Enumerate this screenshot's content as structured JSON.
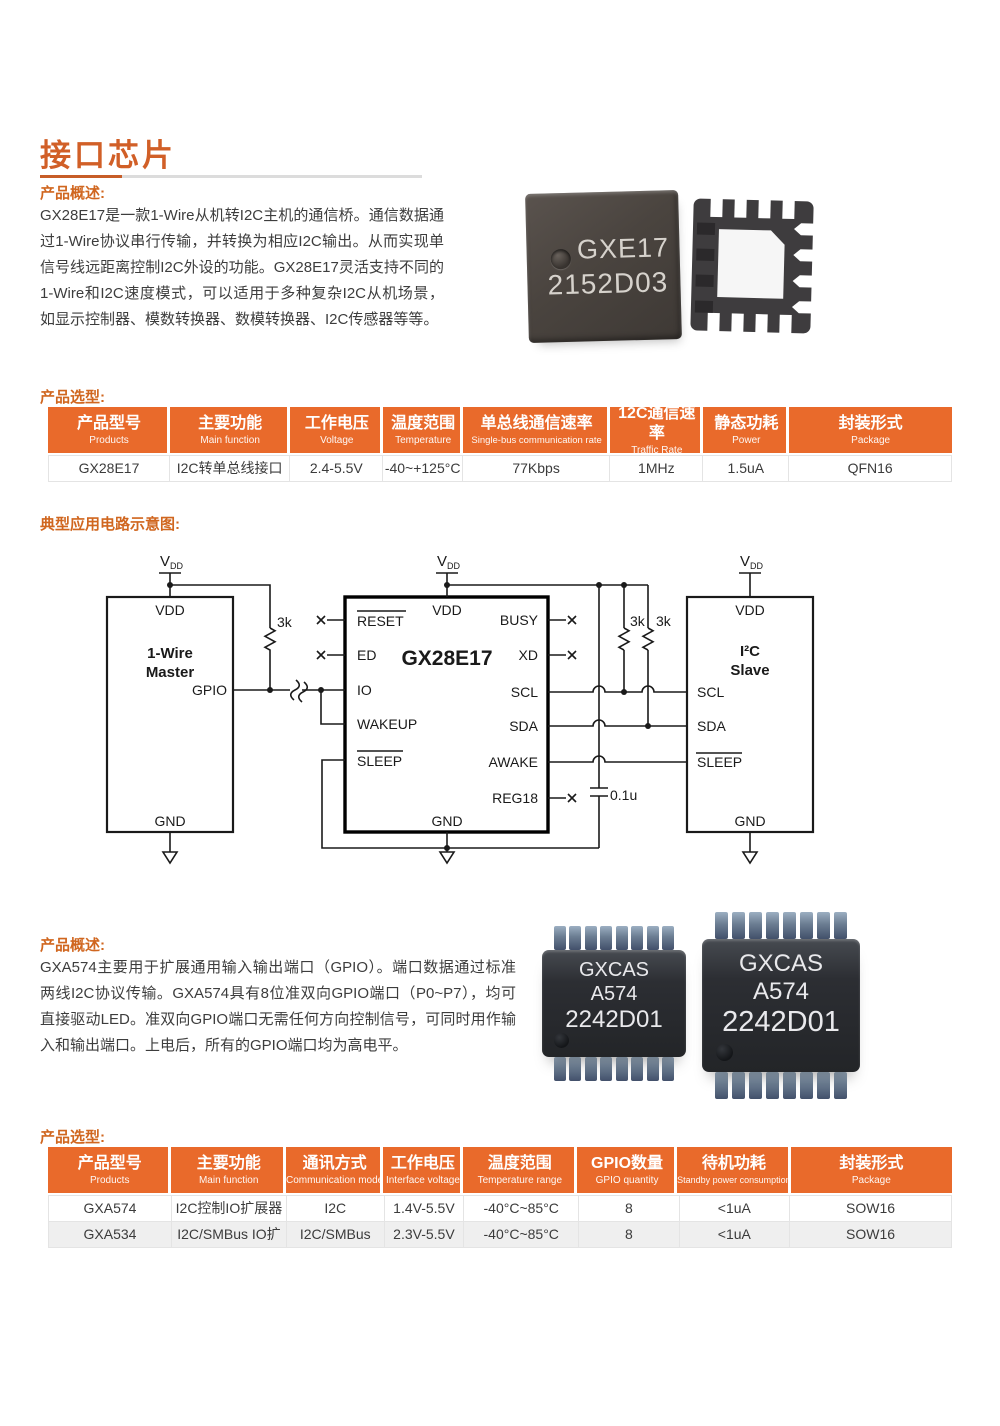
{
  "colors": {
    "accent_orange": "#e96a2b",
    "title_orange": "#d15f27",
    "label_orange": "#d0661f",
    "alt_row_gray": "#efefef"
  },
  "title": "接口芯片",
  "overview1": {
    "label": "产品概述:",
    "text": "GX28E17是一款1-Wire从机转I2C主机的通信桥。通信数据通过1-Wire协议串行传输，并转换为相应I2C输出。从而实现单信号线远距离控制I2C外设的功能。GX28E17灵活支持不同的1-Wire和I2C速度模式，可以适用于多种复杂I2C从机场景，如显示控制器、模数转换器、数模转换器、I2C传感器等等。"
  },
  "chip_photo1": {
    "marking_line1": "GXE17",
    "marking_line2": "2152D03"
  },
  "selection1": {
    "label": "产品选型:",
    "headers": [
      {
        "zh": "产品型号",
        "en": "Products"
      },
      {
        "zh": "主要功能",
        "en": "Main function"
      },
      {
        "zh": "工作电压",
        "en": "Voltage"
      },
      {
        "zh": "温度范围",
        "en": "Temperature"
      },
      {
        "zh": "单总线通信速率",
        "en": "Single-bus communication rate"
      },
      {
        "zh": "12C通信速率",
        "en": "Traffic Rate"
      },
      {
        "zh": "静态功耗",
        "en": "Power"
      },
      {
        "zh": "封装形式",
        "en": "Package"
      }
    ],
    "rows": [
      [
        "GX28E17",
        "I2C转单总线接口",
        "2.4-5.5V",
        "-40~+125°C",
        "77Kbps",
        "1MHz",
        "1.5uA",
        "QFN16"
      ]
    ]
  },
  "circuit": {
    "label": "典型应用电路示意图:",
    "vdd_v": "V",
    "vdd_sub": "DD",
    "master": {
      "pin_vdd": "VDD",
      "title1": "1-Wire",
      "title2": "Master",
      "pin_gpio": "GPIO",
      "pin_gnd": "GND"
    },
    "chip": {
      "name": "GX28E17",
      "pin_vdd": "VDD",
      "pin_gnd": "GND",
      "pin_reset": "RESET",
      "pin_ed": "ED",
      "pin_io": "IO",
      "pin_wakeup": "WAKEUP",
      "pin_sleep": "SLEEP",
      "pin_busy": "BUSY",
      "pin_xd": "XD",
      "pin_scl": "SCL",
      "pin_sda": "SDA",
      "pin_awake": "AWAKE",
      "pin_reg18": "REG18"
    },
    "slave": {
      "title1": "I²C",
      "title2": "Slave",
      "pin_vdd": "VDD",
      "pin_scl": "SCL",
      "pin_sda": "SDA",
      "pin_sleep": "SLEEP",
      "pin_gnd": "GND"
    },
    "r1": "3k",
    "r2": "3k",
    "r3": "3k",
    "cap": "0.1u"
  },
  "overview2": {
    "label": "产品概述:",
    "text": "GXA574主要用于扩展通用输入输出端口（GPIO）。端口数据通过标准两线I2C协议传输。GXA574具有8位准双向GPIO端口（P0~P7），均可直接驱动LED。准双向GPIO端口无需任何方向控制信号，可同时用作输入和输出端口。上电后，所有的GPIO端口均为高电平。"
  },
  "chip_photo2": {
    "marking_line1": "GXCAS",
    "marking_line2": "A574",
    "marking_line3": "2242D01"
  },
  "selection2": {
    "label": "产品选型:",
    "headers": [
      {
        "zh": "产品型号",
        "en": "Products"
      },
      {
        "zh": "主要功能",
        "en": "Main function"
      },
      {
        "zh": "通讯方式",
        "en": "Communication mode"
      },
      {
        "zh": "工作电压",
        "en": "Interface voltage"
      },
      {
        "zh": "温度范围",
        "en": "Temperature range"
      },
      {
        "zh": "GPIO数量",
        "en": "GPIO quantity"
      },
      {
        "zh": "待机功耗",
        "en": "Standby power consumption"
      },
      {
        "zh": "封装形式",
        "en": "Package"
      }
    ],
    "rows": [
      [
        "GXA574",
        "I2C控制IO扩展器",
        "I2C",
        "1.4V-5.5V",
        "-40°C~85°C",
        "8",
        "<1uA",
        "SOW16"
      ],
      [
        "GXA534",
        "I2C/SMBus IO扩展器",
        "I2C/SMBus",
        "2.3V-5.5V",
        "-40°C~85°C",
        "8",
        "<1uA",
        "SOW16"
      ]
    ]
  }
}
